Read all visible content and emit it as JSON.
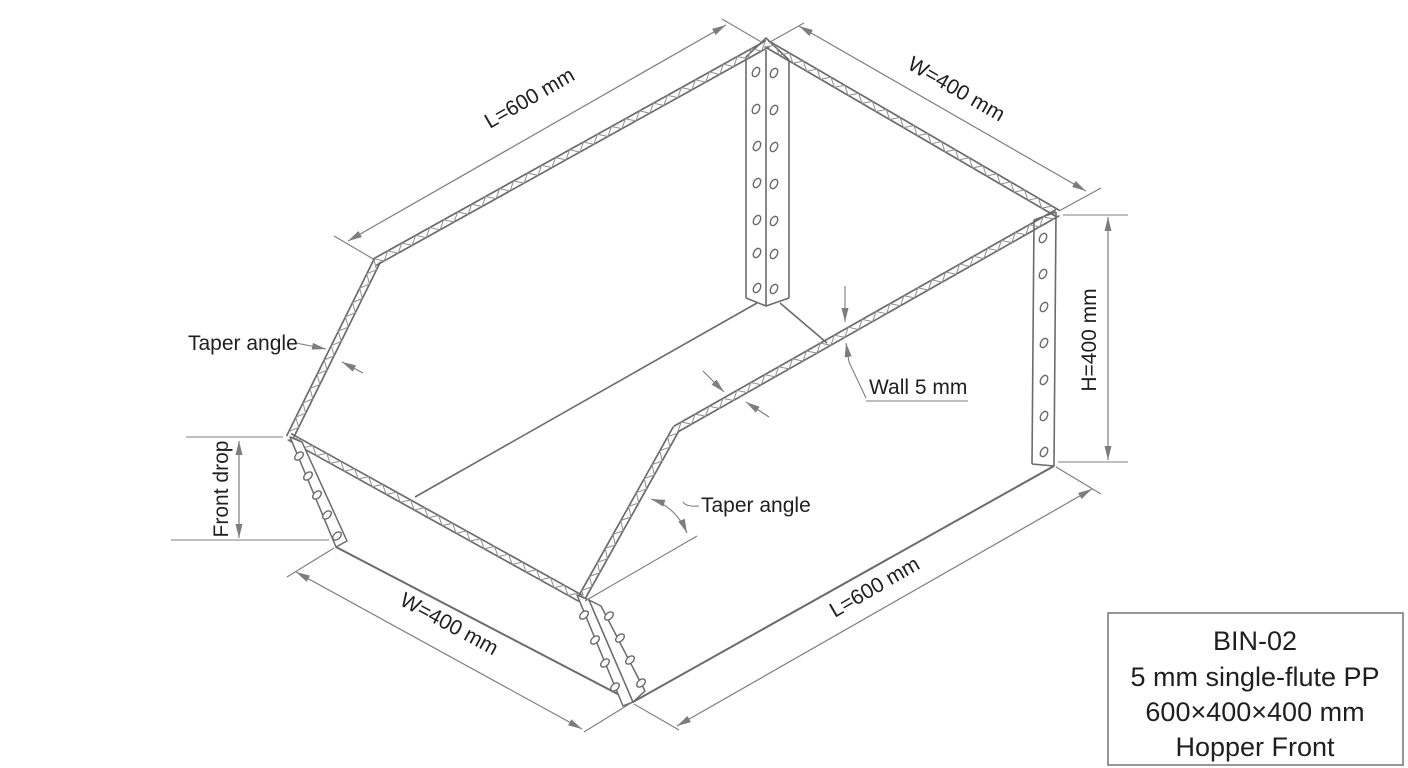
{
  "drawing_labels": {
    "dim_length_top": "L=600 mm",
    "dim_width_back": "W=400 mm",
    "dim_height": "H=400 mm",
    "dim_width_front": "W=400 mm",
    "dim_length_bottom": "L=600 mm",
    "dim_front_drop": "Front drop",
    "callout_taper_left": "Taper angle",
    "callout_taper_right": "Taper angle",
    "callout_wall": "Wall 5 mm"
  },
  "title_block": {
    "part_id": "BIN-02",
    "material": "5 mm single-flute PP",
    "overall_size": "600×400×400 mm",
    "front_style": "Hopper Front"
  },
  "colors": {
    "line": "#6b6b6b",
    "line_light": "#8f8f8f",
    "dim": "#7d7d7d",
    "text": "#1f1f1f",
    "background": "#ffffff"
  }
}
